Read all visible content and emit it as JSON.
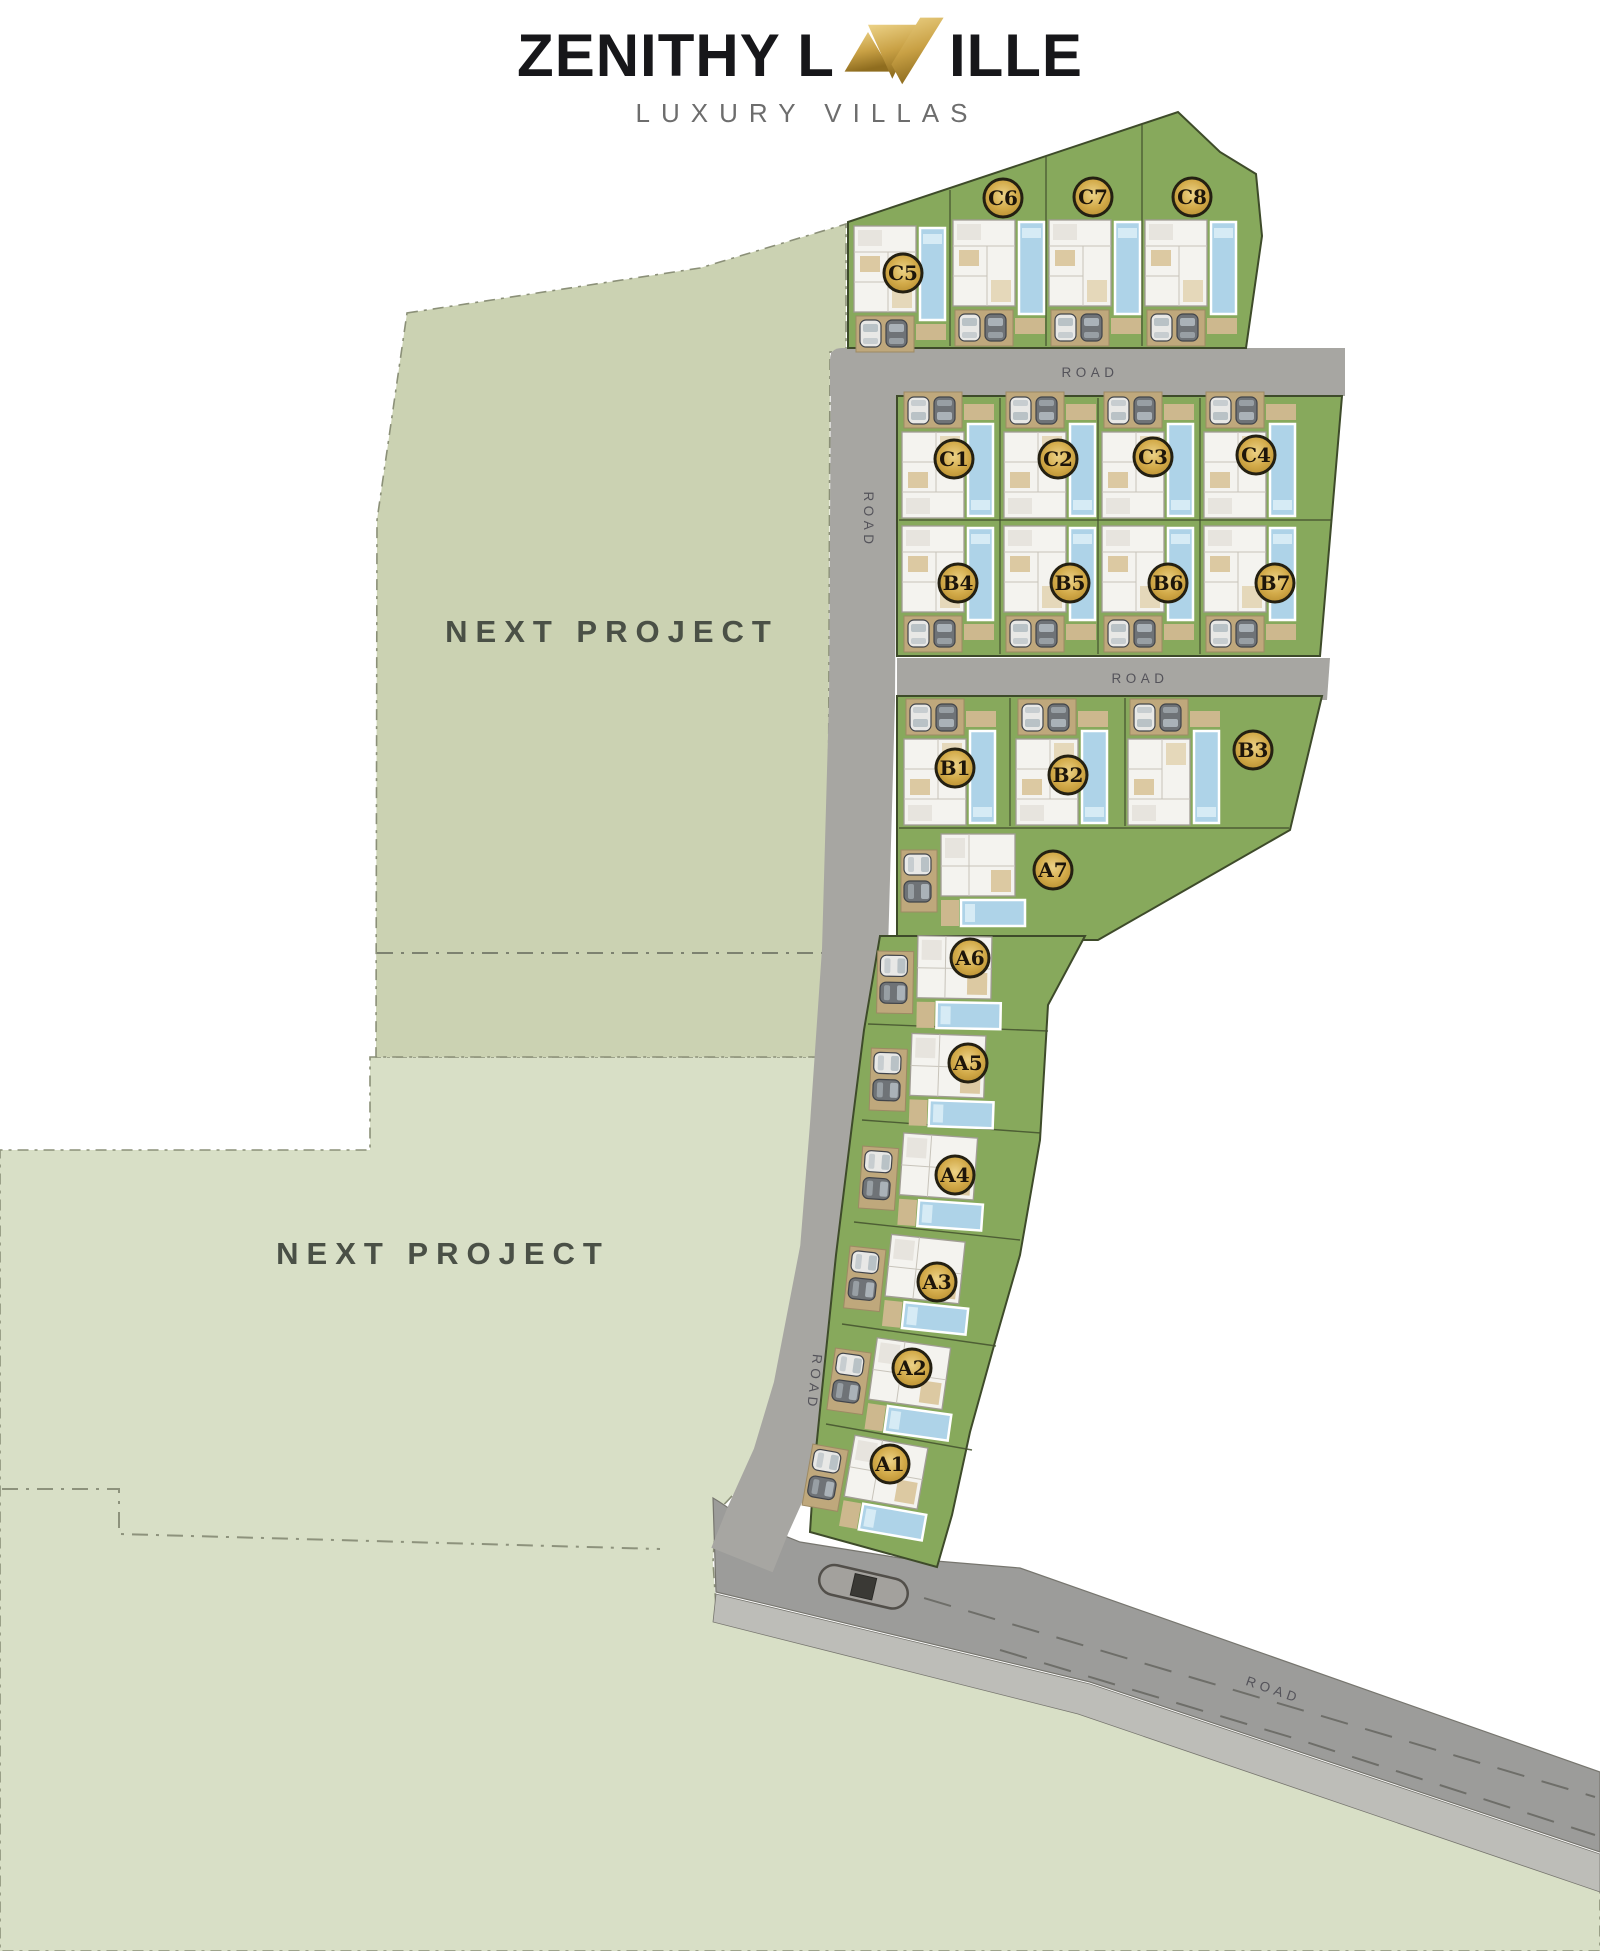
{
  "page_title": "Zenithy Laville Luxury Villas Master Plan",
  "logo": {
    "title_pre": "ZENITHY L",
    "title_post": "ILLE",
    "tagline": "LUXURY VILLAS",
    "emblem_icon": "gold-av-monogram"
  },
  "areas": [
    {
      "id": "next-project-1",
      "label": "NEXT PROJECT",
      "x": 612,
      "y": 642
    },
    {
      "id": "next-project-2",
      "label": "NEXT PROJECT",
      "x": 443,
      "y": 1264
    }
  ],
  "road_labels": [
    {
      "text": "ROAD",
      "x": 1090,
      "y": 377,
      "rot": 0
    },
    {
      "text": "ROAD",
      "x": 864,
      "y": 520,
      "rot": 90
    },
    {
      "text": "ROAD",
      "x": 1140,
      "y": 683,
      "rot": 0
    },
    {
      "text": "ROAD",
      "x": 810,
      "y": 1382,
      "rot": 96
    },
    {
      "text": "ROAD",
      "x": 1272,
      "y": 1694,
      "rot": 19
    }
  ],
  "plots": [
    {
      "label": "C5",
      "badge": [
        903,
        273
      ],
      "villa": {
        "type": "v",
        "x": 852,
        "y": 224
      }
    },
    {
      "label": "C6",
      "badge": [
        1003,
        198
      ],
      "villa": {
        "type": "v",
        "x": 951,
        "y": 218
      }
    },
    {
      "label": "C7",
      "badge": [
        1093,
        197
      ],
      "villa": {
        "type": "v",
        "x": 1047,
        "y": 218
      }
    },
    {
      "label": "C8",
      "badge": [
        1192,
        197
      ],
      "villa": {
        "type": "v",
        "x": 1143,
        "y": 218
      }
    },
    {
      "label": "C1",
      "badge": [
        954,
        459
      ],
      "villa": {
        "type": "v",
        "x": 900,
        "y": 390,
        "flip": true
      }
    },
    {
      "label": "C2",
      "badge": [
        1058,
        459
      ],
      "villa": {
        "type": "v",
        "x": 1002,
        "y": 390,
        "flip": true
      }
    },
    {
      "label": "C3",
      "badge": [
        1153,
        457
      ],
      "villa": {
        "type": "v",
        "x": 1100,
        "y": 390,
        "flip": true
      }
    },
    {
      "label": "C4",
      "badge": [
        1256,
        455
      ],
      "villa": {
        "type": "v",
        "x": 1202,
        "y": 390,
        "flip": true
      }
    },
    {
      "label": "B4",
      "badge": [
        958,
        583
      ],
      "villa": {
        "type": "v",
        "x": 900,
        "y": 524
      }
    },
    {
      "label": "B5",
      "badge": [
        1070,
        583
      ],
      "villa": {
        "type": "v",
        "x": 1002,
        "y": 524
      }
    },
    {
      "label": "B6",
      "badge": [
        1168,
        583
      ],
      "villa": {
        "type": "v",
        "x": 1100,
        "y": 524
      }
    },
    {
      "label": "B7",
      "badge": [
        1275,
        583
      ],
      "villa": {
        "type": "v",
        "x": 1202,
        "y": 524
      }
    },
    {
      "label": "B1",
      "badge": [
        955,
        768
      ],
      "villa": {
        "type": "v",
        "x": 902,
        "y": 697,
        "flip": true
      }
    },
    {
      "label": "B2",
      "badge": [
        1068,
        775
      ],
      "villa": {
        "type": "v",
        "x": 1014,
        "y": 697,
        "flip": true
      }
    },
    {
      "label": "B3",
      "badge": [
        1253,
        750
      ],
      "villa": {
        "type": "v",
        "x": 1126,
        "y": 697,
        "flip": true
      }
    },
    {
      "label": "A7",
      "badge": [
        1053,
        870
      ],
      "villa": {
        "type": "h",
        "x": 899,
        "y": 832,
        "rot": 0
      }
    },
    {
      "label": "A6",
      "badge": [
        970,
        958
      ],
      "villa": {
        "type": "h",
        "x": 876,
        "y": 933,
        "rot": 1
      }
    },
    {
      "label": "A5",
      "badge": [
        968,
        1063
      ],
      "villa": {
        "type": "h",
        "x": 870,
        "y": 1030,
        "rot": 2
      }
    },
    {
      "label": "A4",
      "badge": [
        955,
        1175
      ],
      "villa": {
        "type": "h",
        "x": 862,
        "y": 1128,
        "rot": 4
      }
    },
    {
      "label": "A3",
      "badge": [
        937,
        1282
      ],
      "villa": {
        "type": "h",
        "x": 850,
        "y": 1228,
        "rot": 6
      }
    },
    {
      "label": "A2",
      "badge": [
        912,
        1368
      ],
      "villa": {
        "type": "h",
        "x": 836,
        "y": 1330,
        "rot": 8
      }
    },
    {
      "label": "A1",
      "badge": [
        890,
        1464
      ],
      "villa": {
        "type": "h",
        "x": 814,
        "y": 1426,
        "rot": 10
      }
    }
  ],
  "colors": {
    "gold_light": "#ecd287",
    "gold": "#d9b255",
    "gold_deep": "#b68c2e",
    "badge_ring": "#242012",
    "badge_text": "#1d150a",
    "grass": "#87a95c",
    "block_line": "#3e4b2a",
    "sage": "#cbd2b2",
    "sage_pale": "#d8dfc6",
    "parcel_line": "#8b9078",
    "road": "#a7a6a2",
    "road_main": "#9c9c9a",
    "road_shoulder": "#bdbdb8",
    "road_line": "#6e6e69",
    "road_edge": "#77766f",
    "pool": "#aed3e8",
    "pool_light": "#d6ebf5",
    "building": "#f4f3ef",
    "building_line": "#a09c93",
    "drive": "#bfa87c",
    "drive_line": "#9d8a64",
    "deck": "#cdb88e",
    "label_text": "#4a5046",
    "road_text": "#54535a",
    "fence": "#44522e"
  }
}
